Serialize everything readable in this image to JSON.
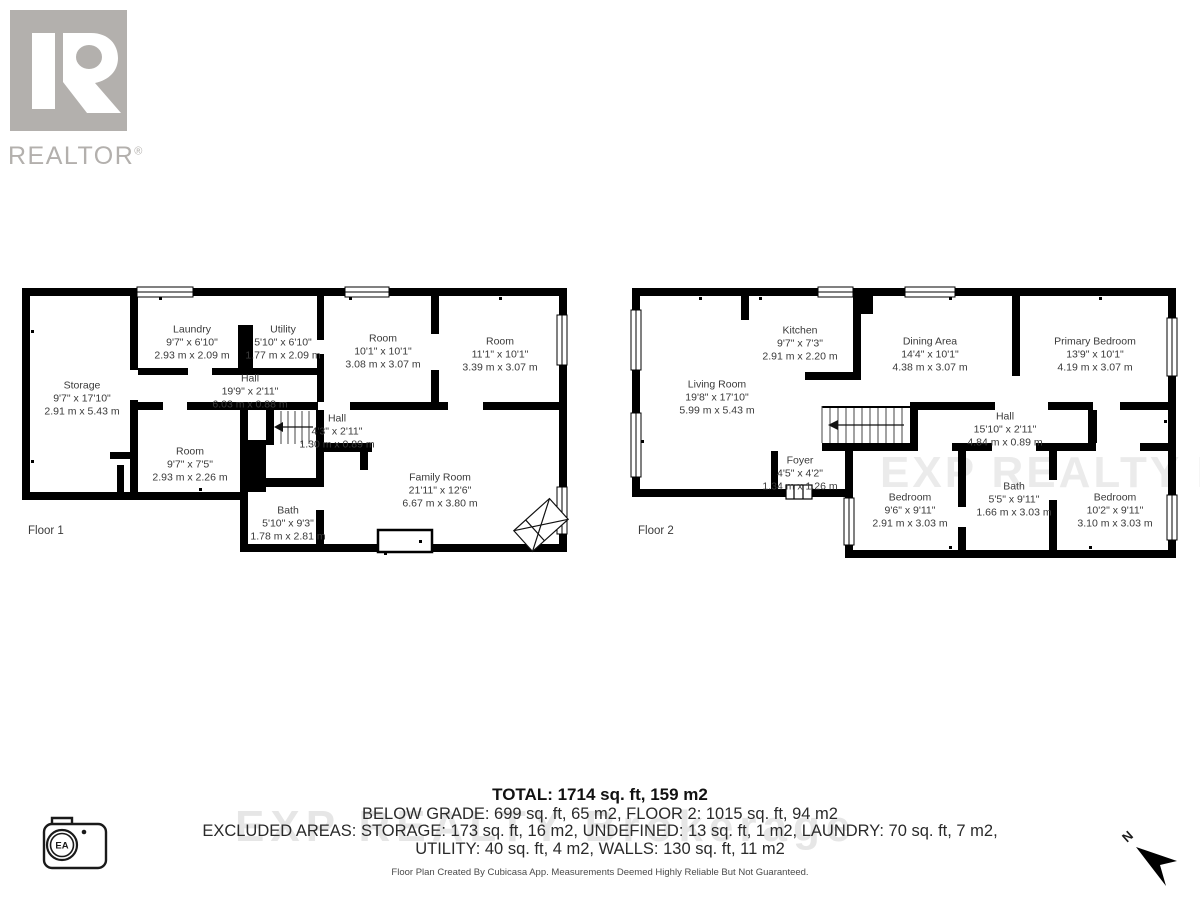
{
  "branding": {
    "logo_text": "REALTOR",
    "registered": "®"
  },
  "floor1": {
    "label": "Floor 1",
    "rooms": {
      "storage": {
        "name": "Storage",
        "imperial": "9'7\" x 17'10\"",
        "metric": "2.91 m x 5.43 m"
      },
      "laundry": {
        "name": "Laundry",
        "imperial": "9'7\" x 6'10\"",
        "metric": "2.93 m x 2.09 m"
      },
      "utility": {
        "name": "Utility",
        "imperial": "5'10\" x 6'10\"",
        "metric": "1.77 m x 2.09 m"
      },
      "hall": {
        "name": "Hall",
        "imperial": "19'9\" x 2'11\"",
        "metric": "6.03 m x 0.88 m"
      },
      "room_a": {
        "name": "Room",
        "imperial": "10'1\" x 10'1\"",
        "metric": "3.08 m x 3.07 m"
      },
      "room_b": {
        "name": "Room",
        "imperial": "11'1\" x 10'1\"",
        "metric": "3.39 m x 3.07 m"
      },
      "room_c": {
        "name": "Room",
        "imperial": "9'7\" x 7'5\"",
        "metric": "2.93 m x 2.26 m"
      },
      "hall_small": {
        "name": "Hall",
        "imperial": "4'3\" x 2'11\"",
        "metric": "1.30 m x 0.89 m"
      },
      "bath": {
        "name": "Bath",
        "imperial": "5'10\" x 9'3\"",
        "metric": "1.78 m x 2.81 m"
      },
      "family": {
        "name": "Family Room",
        "imperial": "21'11\" x 12'6\"",
        "metric": "6.67 m x 3.80 m"
      }
    }
  },
  "floor2": {
    "label": "Floor 2",
    "rooms": {
      "kitchen": {
        "name": "Kitchen",
        "imperial": "9'7\" x 7'3\"",
        "metric": "2.91 m x 2.20 m"
      },
      "living": {
        "name": "Living Room",
        "imperial": "19'8\" x 17'10\"",
        "metric": "5.99 m x 5.43 m"
      },
      "dining": {
        "name": "Dining Area",
        "imperial": "14'4\" x 10'1\"",
        "metric": "4.38 m x 3.07 m"
      },
      "primary": {
        "name": "Primary Bedroom",
        "imperial": "13'9\" x 10'1\"",
        "metric": "4.19 m x 3.07 m"
      },
      "hall": {
        "name": "Hall",
        "imperial": "15'10\" x 2'11\"",
        "metric": "4.84 m x 0.89 m"
      },
      "foyer": {
        "name": "Foyer",
        "imperial": "4'5\" x 4'2\"",
        "metric": "1.34 m x 1.26 m"
      },
      "bedroom_left": {
        "name": "Bedroom",
        "imperial": "9'6\" x 9'11\"",
        "metric": "2.91 m x 3.03 m"
      },
      "bath": {
        "name": "Bath",
        "imperial": "5'5\" x 9'11\"",
        "metric": "1.66 m x 3.03 m"
      },
      "bedroom_right": {
        "name": "Bedroom",
        "imperial": "10'2\" x 9'11\"",
        "metric": "3.10 m x 3.03 m"
      }
    }
  },
  "summary": {
    "total": "TOTAL: 1714 sq. ft, 159 m2",
    "below_grade": "BELOW GRADE: 699 sq. ft, 65 m2, FLOOR 2: 1015 sq. ft, 94 m2",
    "excluded_1": "EXCLUDED AREAS: STORAGE: 173 sq. ft, 16 m2, UNDEFINED: 13 sq. ft, 1 m2, LAUNDRY: 70 sq. ft, 7 m2,",
    "excluded_2": "UTILITY: 40 sq. ft, 4 m2, WALLS: 130 sq. ft, 11 m2"
  },
  "disclaimer": "Floor Plan Created By Cubicasa App. Measurements Deemed Highly Reliable But Not Guaranteed.",
  "watermark": "EXP REALTY Brokerage",
  "compass": {
    "label": "N"
  },
  "camera_badge": {
    "label": "EA"
  },
  "colors": {
    "wall": "#000000",
    "label_text": "#3a3a3a",
    "logo_gray": "#b3b0ad",
    "watermark": "#bdbdbd"
  }
}
